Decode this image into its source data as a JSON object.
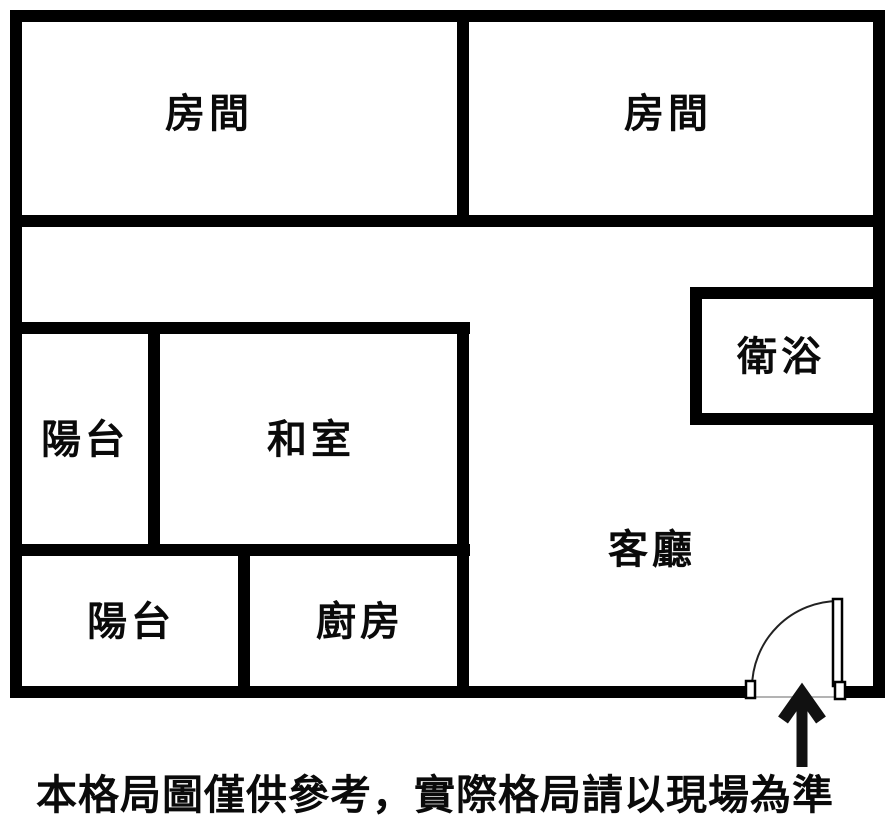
{
  "floorplan": {
    "rooms": [
      {
        "name": "bedroom-top-left",
        "label": "房間"
      },
      {
        "name": "bedroom-top-right",
        "label": "房間"
      },
      {
        "name": "bathroom",
        "label": "衛浴"
      },
      {
        "name": "balcony-middle",
        "label": "陽台"
      },
      {
        "name": "tatami-room",
        "label": "和室"
      },
      {
        "name": "living-room",
        "label": "客廳"
      },
      {
        "name": "balcony-bottom",
        "label": "陽台"
      },
      {
        "name": "kitchen",
        "label": "廚房"
      }
    ],
    "icons": {
      "entry_door": "door-swing-arc",
      "entry_arrow": "arrow-up-icon"
    },
    "colors": {
      "wall": "#000000",
      "background": "#ffffff",
      "text": "#0a0a0a"
    }
  },
  "caption": "本格局圖僅供參考，實際格局請以現場為準"
}
